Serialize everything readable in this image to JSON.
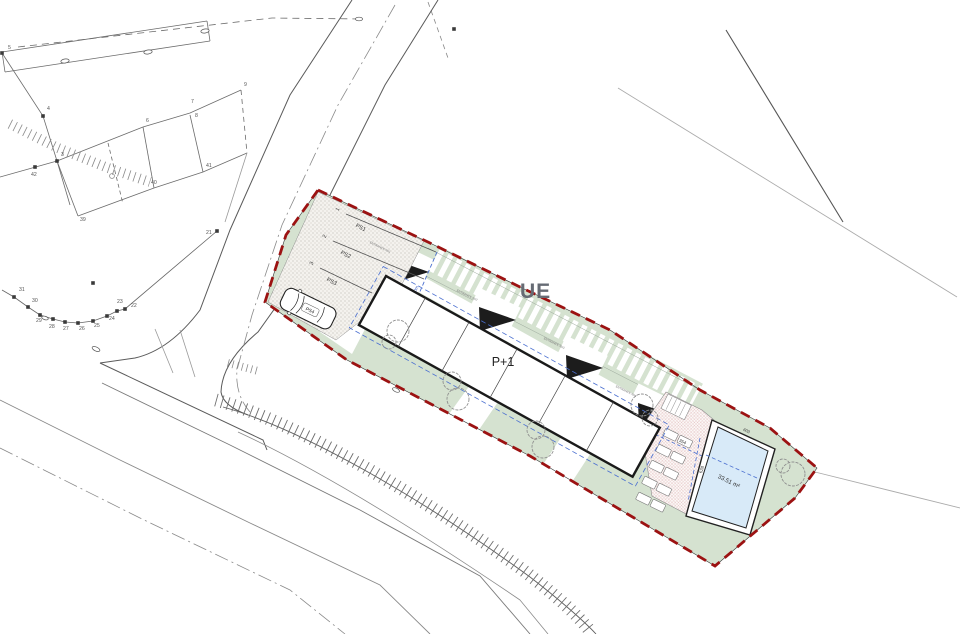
{
  "plan": {
    "building": {
      "label": "P+1"
    },
    "zone_label": "UE",
    "parking": {
      "stalls": [
        "PS1",
        "PS2",
        "PS3",
        "PS4"
      ],
      "numbers": [
        "1",
        "2",
        "3"
      ],
      "stall_dim": "5.50m"
    },
    "entrances": [
      "ENTRANCE No1",
      "ENTRANCE No2",
      "ENTRANCE No3",
      "ENTRANCE No4"
    ],
    "pool": {
      "area": "33.51 m²",
      "side_dim": "628",
      "edge_dim": "603"
    },
    "terrace": {
      "dim": "354"
    },
    "survey_points": [
      "3",
      "4",
      "5",
      "6",
      "7",
      "8",
      "9",
      "21",
      "22",
      "23",
      "24",
      "25",
      "26",
      "27",
      "28",
      "29",
      "30",
      "31",
      "39",
      "40",
      "41",
      "42"
    ],
    "colors": {
      "boundary": "#9c1212",
      "green": "#d5e2d0",
      "pool": "#d8eaf8",
      "dim_blue": "#4a6fd0"
    }
  }
}
